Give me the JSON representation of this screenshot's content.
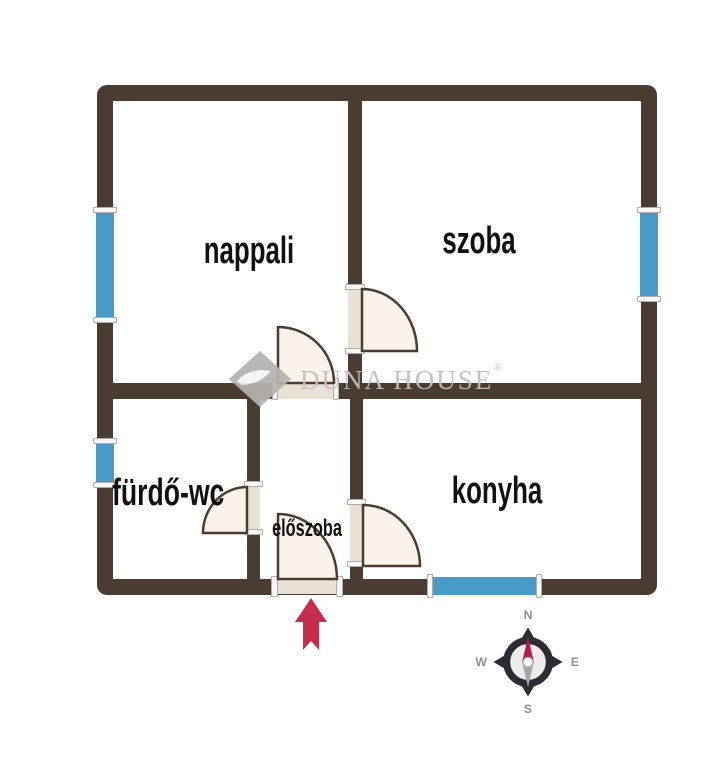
{
  "colors": {
    "background": "#ffffff",
    "wall": "#4a3c31",
    "window": "#4a9ac7",
    "window_cap": "#f8f8f8",
    "door_fill": "#fbf3ea",
    "door_stroke": "#4a3c31",
    "threshold": "#e9e1d6",
    "watermark": "#c2c0be",
    "arrow": "#c62c4e",
    "compass_ring": "#2d2c34",
    "compass_inner": "#edecea",
    "compass_letter": "#908e8c",
    "needle_north": "#b01f4a",
    "needle_south": "#a8a6a4"
  },
  "rooms": [
    {
      "name": "nappali",
      "label": "nappali"
    },
    {
      "name": "szoba",
      "label": "szoba"
    },
    {
      "name": "furdo-wc",
      "label": "fürdő-wc"
    },
    {
      "name": "eloszoba",
      "label": "előszoba"
    },
    {
      "name": "konyha",
      "label": "konyha"
    }
  ],
  "watermark": {
    "word1": "Duna",
    "word2": "House",
    "registered": "®"
  },
  "compass": {
    "n": "N",
    "e": "E",
    "s": "S",
    "w": "W"
  }
}
